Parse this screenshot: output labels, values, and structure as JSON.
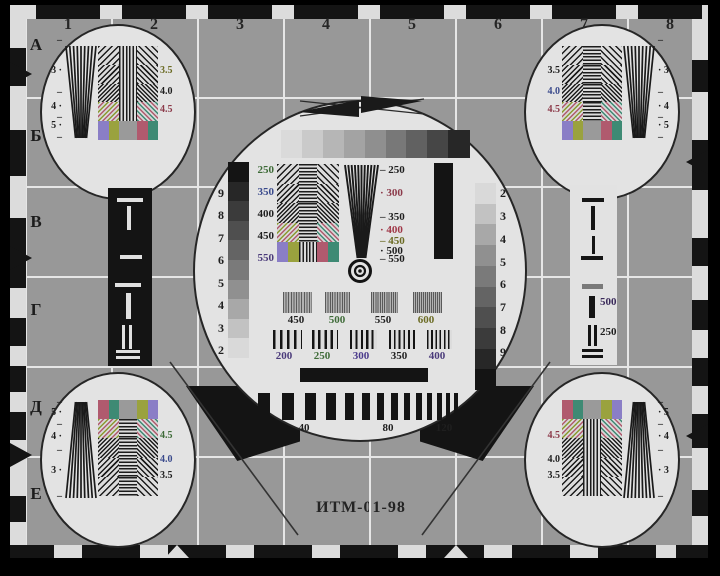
{
  "card": {
    "title": "ИТМ-01-98",
    "maker": "©ОАО ВНИИТР",
    "grid": {
      "columns": [
        "1",
        "2",
        "3",
        "4",
        "5",
        "6",
        "7",
        "8"
      ],
      "rows": [
        "А",
        "Б",
        "В",
        "Г",
        "Д",
        "Е"
      ]
    },
    "colors": {
      "background": "#989898",
      "grid_line": "#e6e6e6",
      "circle_fill": "#e3e3e3",
      "ink": "#141414"
    },
    "center": {
      "gray_strip": [
        "#dadada",
        "#cacaca",
        "#b6b6b6",
        "#a3a3a3",
        "#8f8f8f",
        "#787878",
        "#616161",
        "#464646",
        "#272727"
      ],
      "left_stair": {
        "numbers": [
          "9",
          "8",
          "7",
          "6",
          "5",
          "4",
          "3",
          "2"
        ],
        "shades": [
          "#141414",
          "#272727",
          "#3b3b3b",
          "#4f4f4f",
          "#646464",
          "#7a7a7a",
          "#909090",
          "#a8a8a8",
          "#c2c2c2",
          "#d9d9d9"
        ]
      },
      "right_stair": {
        "numbers": [
          "2",
          "3",
          "4",
          "5",
          "6",
          "7",
          "8",
          "9"
        ],
        "shades": [
          "#d9d9d9",
          "#c2c2c2",
          "#a8a8a8",
          "#909090",
          "#7a7a7a",
          "#646464",
          "#4f4f4f",
          "#3b3b3b",
          "#272727",
          "#141414"
        ]
      },
      "left_labels": [
        {
          "t": "250",
          "c": "#3e6b38"
        },
        {
          "t": "350",
          "c": "#3a4a8c"
        },
        {
          "t": "400",
          "c": "#1f1f1f"
        },
        {
          "t": "450",
          "c": "#1f1f1f"
        },
        {
          "t": "550",
          "c": "#4a3a7a"
        }
      ],
      "wedge_labels": [
        {
          "t": "– 250",
          "c": "#1f1f1f"
        },
        {
          "t": "·  300",
          "c": "#8c3a4a"
        },
        {
          "t": "– 350",
          "c": "#1f1f1f"
        },
        {
          "t": "·  400",
          "c": "#a03848"
        },
        {
          "t": "– 450",
          "c": "#6b6b24"
        },
        {
          "t": "·  500",
          "c": "#1f1f1f"
        },
        {
          "t": "– 550",
          "c": "#1f1f1f"
        }
      ],
      "fine_labels": [
        {
          "t": "450",
          "c": "#1f1f1f"
        },
        {
          "t": "500",
          "c": "#3e6b38"
        },
        {
          "t": "550",
          "c": "#1f1f1f"
        },
        {
          "t": "600",
          "c": "#6b6b24"
        }
      ],
      "coarse_labels": [
        {
          "t": "200",
          "c": "#4a3a7a"
        },
        {
          "t": "250",
          "c": "#3e6b38"
        },
        {
          "t": "300",
          "c": "#4a3a8c"
        },
        {
          "t": "350",
          "c": "#1f1f1f"
        },
        {
          "t": "400",
          "c": "#4a3a7a"
        }
      ],
      "bar_labels": [
        "40",
        "80",
        "120"
      ]
    },
    "right_panel": [
      {
        "t": "500",
        "c": "#3a2a5a"
      },
      {
        "t": "250",
        "c": "#1f1f1f"
      }
    ],
    "corners": {
      "tl": {
        "ticks": [
          "–",
          "3 ·",
          "–",
          "4 ·",
          "–",
          "5 ·",
          "–"
        ],
        "labels": [
          {
            "t": "3.5",
            "c": "#6b6b24"
          },
          {
            "t": "4.0",
            "c": "#1f1f1f"
          },
          {
            "t": "4.5",
            "c": "#8c3a4a"
          }
        ]
      },
      "tr": {
        "ticks": [
          "–",
          "· 3",
          "–",
          "· 4",
          "–",
          "· 5",
          "–"
        ],
        "labels": [
          {
            "t": "3.5",
            "c": "#1f1f1f"
          },
          {
            "t": "4.0",
            "c": "#3a4a8c"
          },
          {
            "t": "4.5",
            "c": "#8c3a4a"
          }
        ]
      },
      "bl": {
        "ticks": [
          "–",
          "5 ·",
          "–",
          "4 ·",
          "–",
          "3 ·",
          "–"
        ],
        "labels": [
          {
            "t": "4.5",
            "c": "#3e6b38"
          },
          {
            "t": "4.0",
            "c": "#3a4a8c"
          },
          {
            "t": "3.5",
            "c": "#1f1f1f"
          }
        ]
      },
      "br": {
        "ticks": [
          "–",
          "· 5",
          "–",
          "· 4",
          "–",
          "· 3",
          "–"
        ],
        "labels": [
          {
            "t": "4.5",
            "c": "#8c3a4a"
          },
          {
            "t": "4.0",
            "c": "#1f1f1f"
          },
          {
            "t": "3.5",
            "c": "#1f1f1f"
          }
        ]
      }
    }
  }
}
